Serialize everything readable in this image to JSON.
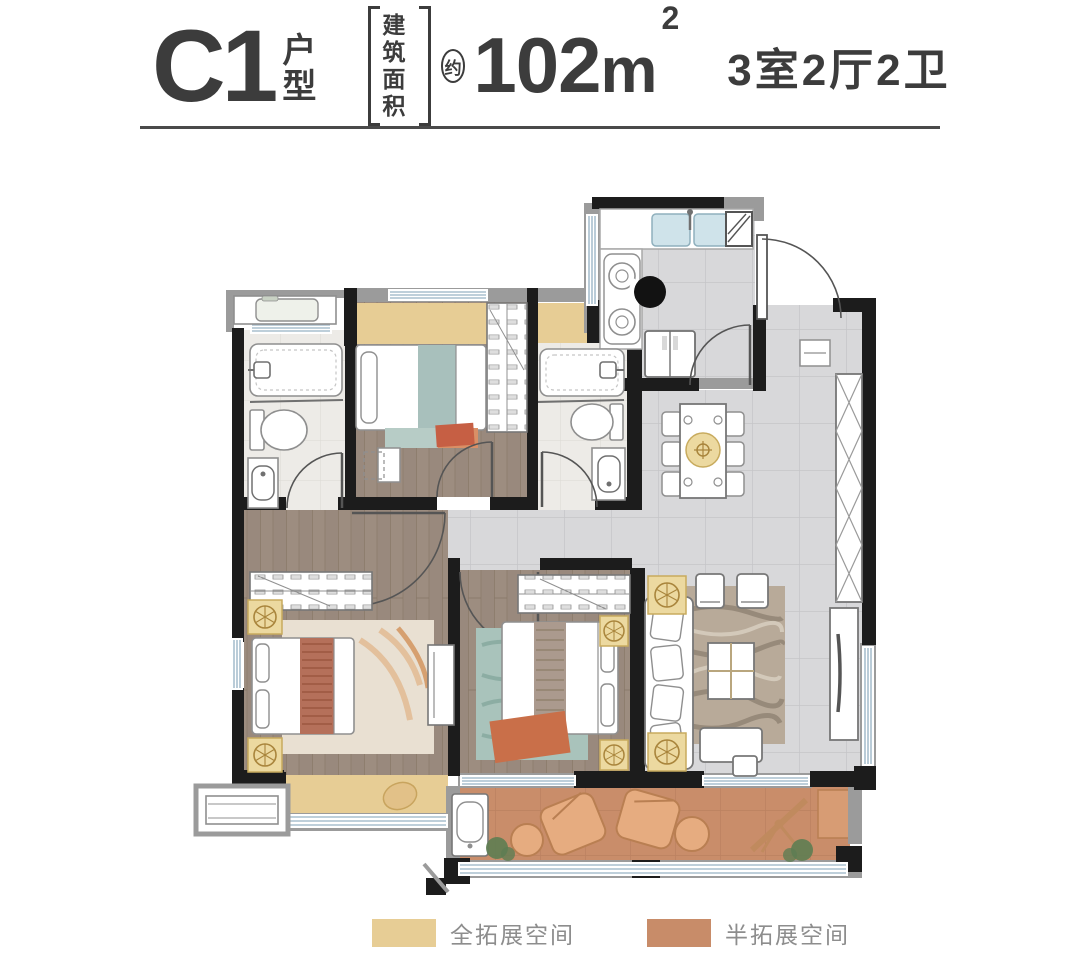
{
  "header": {
    "unit_code": "C1",
    "unit_type_top": "户",
    "unit_type_bottom": "型",
    "area_label_line1": "建筑",
    "area_label_line2": "面积",
    "approx": "约",
    "area_number": "102",
    "area_unit": "m",
    "area_exponent": "2",
    "rooms_summary": "3室2厅2卫"
  },
  "legend": {
    "items": [
      {
        "label": "全拓展空间",
        "color": "#e7cd95"
      },
      {
        "label": "半拓展空间",
        "color": "#c88c69"
      }
    ]
  },
  "palette": {
    "heading_text": "#3c3c3c",
    "legend_text": "#8d8d8d",
    "wall_black": "#1c1c1c",
    "wall_gray": "#9b9b9b",
    "wood_floor": "#9d8d80",
    "tile_floor": "#d8d8da",
    "bath_floor": "#edebe7",
    "balcony_floor": "#c98d6a",
    "expansion_full_tan": "#e7cd95",
    "expansion_half_orange": "#c88c69"
  }
}
